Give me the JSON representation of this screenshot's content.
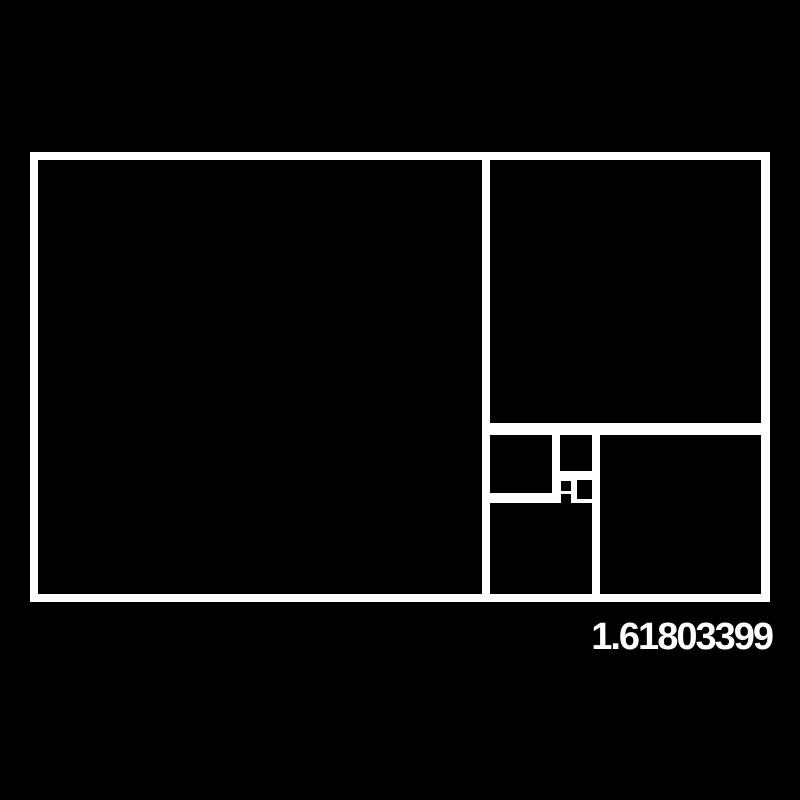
{
  "figure": {
    "name": "golden-ratio-fibonacci-rectangle",
    "ratio_label": "1.61803399",
    "colors": {
      "background": "#000000",
      "line": "#ffffff"
    },
    "panel": {
      "x": 30,
      "y": 152,
      "width": 740,
      "height": 450
    },
    "cells": [
      {
        "name": "fibonacci-square-1-largest",
        "x": 8,
        "y": 8,
        "w": 444,
        "h": 434
      },
      {
        "name": "fibonacci-square-2-top-right",
        "x": 460,
        "y": 8,
        "w": 271,
        "h": 263
      },
      {
        "name": "fibonacci-square-3-bottom-right",
        "x": 570,
        "y": 283,
        "w": 161,
        "h": 159
      },
      {
        "name": "fibonacci-square-4-bottom-mid",
        "x": 460,
        "y": 351,
        "w": 102,
        "h": 91
      },
      {
        "name": "fibonacci-square-5",
        "x": 460,
        "y": 283,
        "w": 62,
        "h": 58
      },
      {
        "name": "fibonacci-square-6",
        "x": 530,
        "y": 283,
        "w": 32,
        "h": 36
      },
      {
        "name": "fibonacci-square-7",
        "x": 547,
        "y": 328,
        "w": 15,
        "h": 19
      },
      {
        "name": "fibonacci-square-8",
        "x": 531,
        "y": 329,
        "w": 10,
        "h": 10
      },
      {
        "name": "fibonacci-square-9-smallest",
        "x": 531,
        "y": 342,
        "w": 10,
        "h": 9
      }
    ]
  }
}
